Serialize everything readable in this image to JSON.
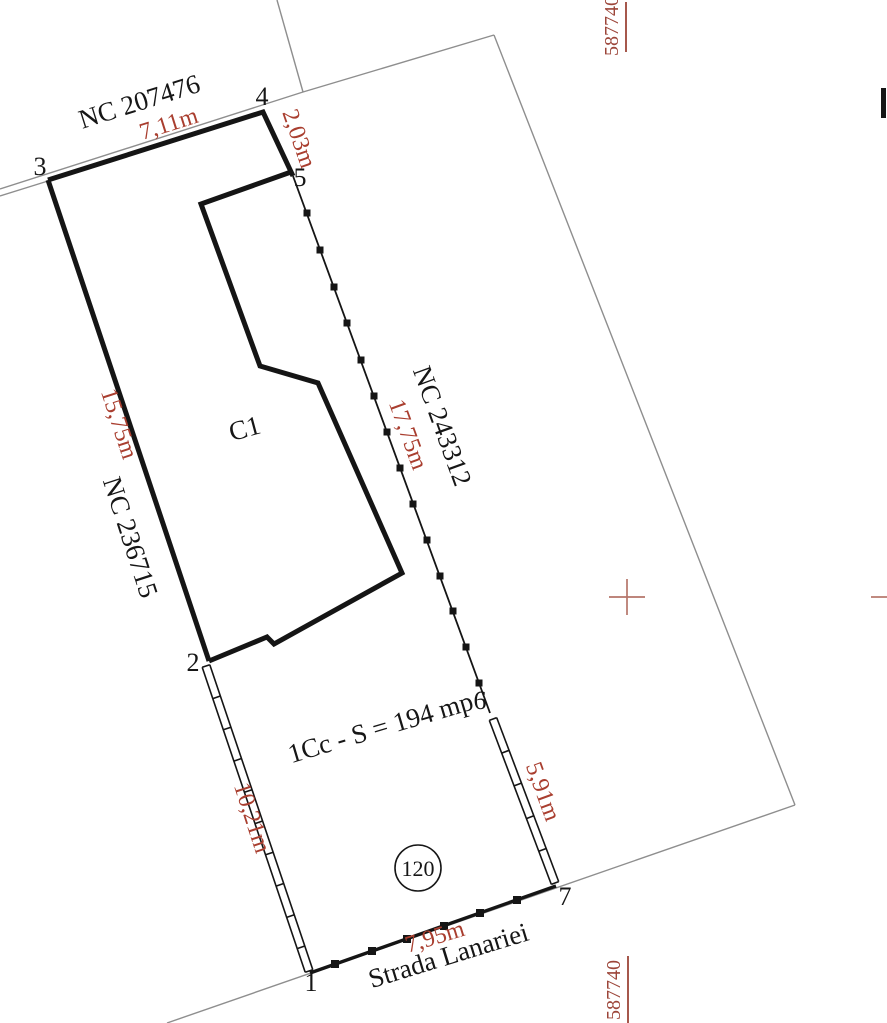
{
  "colors": {
    "dimension_red": "#a93e2f",
    "coordinate_red": "#9c4539",
    "cross_red": "#b5756a",
    "line_black": "#151515",
    "line_gray": "#8e8e8e"
  },
  "grid": {
    "coord_top": "587740",
    "coord_bottom": "587740"
  },
  "neighbors": {
    "top": "NC 207476",
    "right": "NC 243312",
    "left": "NC 236715"
  },
  "building": {
    "label": "C1"
  },
  "parcel": {
    "use_area_label": "1Cc - S = 194 mp",
    "plan_number": "120",
    "street_name": "Strada Lanariei"
  },
  "points": {
    "p1": "1",
    "p2": "2",
    "p3": "3",
    "p4": "4",
    "p5": "5",
    "p6": "6",
    "p7": "7"
  },
  "dimensions": {
    "d34": "7,11m",
    "d45": "2,03m",
    "d56": "17,75m",
    "d23": "15,75m",
    "d12": "10,21m",
    "d67": "5,91m",
    "d71": "7,95m"
  }
}
